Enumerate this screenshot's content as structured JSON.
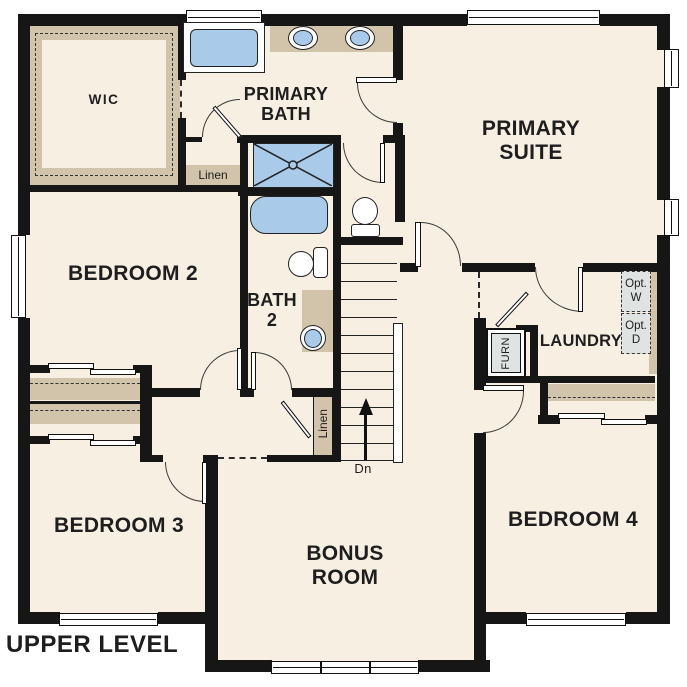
{
  "plan_title": "UPPER LEVEL",
  "rooms": {
    "wic": "WIC",
    "primary_bath": "PRIMARY BATH",
    "primary_suite": "PRIMARY SUITE",
    "bedroom_2": "BEDROOM 2",
    "bath_2": "BATH 2",
    "laundry": "LAUNDRY",
    "bedroom_3": "BEDROOM 3",
    "bonus_room": "BONUS ROOM",
    "bedroom_4": "BEDROOM 4"
  },
  "closets": {
    "linen_primary": "Linen",
    "linen_hall": "Linen",
    "furnace": "FURN",
    "optional_washer": "Opt. W",
    "optional_dryer": "Opt. D"
  },
  "stairs": {
    "down_label": "Dn"
  },
  "fixture_icons": {
    "tub": "bathtub-icon",
    "shower": "shower-icon",
    "toilet": "toilet-icon",
    "sink": "sink-icon",
    "stairs": "stairs-icon",
    "window": "window-icon",
    "door": "door-swing-icon",
    "closet_shelf": "closet-shelf-icon"
  },
  "colors": {
    "floor": "#f7f0e2",
    "wall": "#161616",
    "casework_tan": "#d2c4aa",
    "fixture_blue": "#a9cbe9",
    "appliance_gray": "#dfe3e2",
    "background": "#ffffff"
  }
}
